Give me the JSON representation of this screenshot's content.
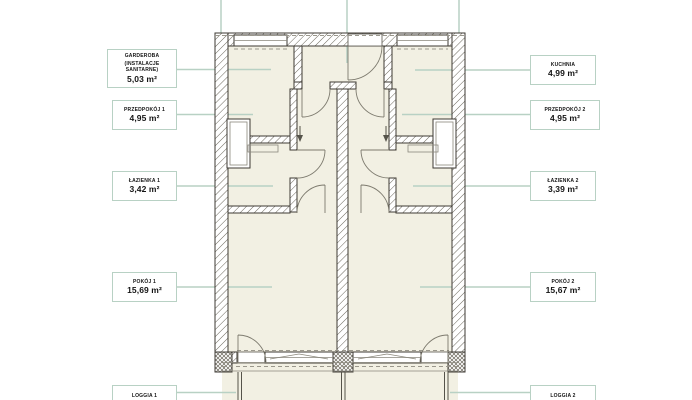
{
  "colors": {
    "accent": "#b8d1c4",
    "room": "#f2f0e3",
    "wall": "#3d3a33",
    "hatch": "#6b675c",
    "dash": "#9a978c",
    "text": "#141414",
    "bg": "#ffffff"
  },
  "labels": {
    "garderoba": {
      "line1": "GARDEROBA",
      "line2": "(INSTALACJE SANITARNE)",
      "area": "5,03 m²"
    },
    "przedpokoj1": {
      "name": "PRZEDPOKÓJ 1",
      "area": "4,95 m²"
    },
    "lazienka1": {
      "name": "ŁAZIENKA 1",
      "area": "3,42 m²"
    },
    "pokoj1": {
      "name": "POKÓJ 1",
      "area": "15,69 m²"
    },
    "loggia1": {
      "name": "LOGGIA 1"
    },
    "kuchnia": {
      "name": "KUCHNIA",
      "area": "4,99 m²"
    },
    "przedpokoj2": {
      "name": "PRZEDPOKÓJ 2",
      "area": "4,95 m²"
    },
    "lazienka2": {
      "name": "ŁAZIENKA 2",
      "area": "3,39 m²"
    },
    "pokoj2": {
      "name": "POKÓJ 2",
      "area": "15,67 m²"
    },
    "loggia2": {
      "name": "LOGGIA 2"
    }
  }
}
